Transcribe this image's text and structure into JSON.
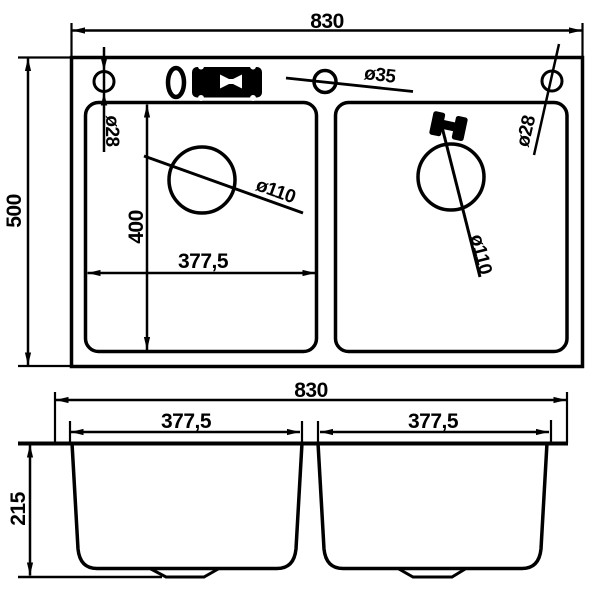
{
  "colors": {
    "line": "#000000",
    "background": "#ffffff"
  },
  "top_view": {
    "overall_width_label": "830",
    "overall_depth_label": "500",
    "left_hole_diameter_label": "ø28",
    "right_hole_diameter_label": "ø28",
    "faucet_hole_diameter_label": "ø35",
    "left_drain_diameter_label": "ø110",
    "right_drain_diameter_label": "ø110",
    "bowl_inner_depth_label": "400",
    "bowl_inner_width_label": "377,5",
    "icons": {
      "faucet": "faucet-top-icon",
      "handle": "handle-top-icon"
    }
  },
  "front_view": {
    "overall_width_label": "830",
    "left_bowl_width_label": "377,5",
    "right_bowl_width_label": "377,5",
    "bowl_height_label": "215"
  }
}
